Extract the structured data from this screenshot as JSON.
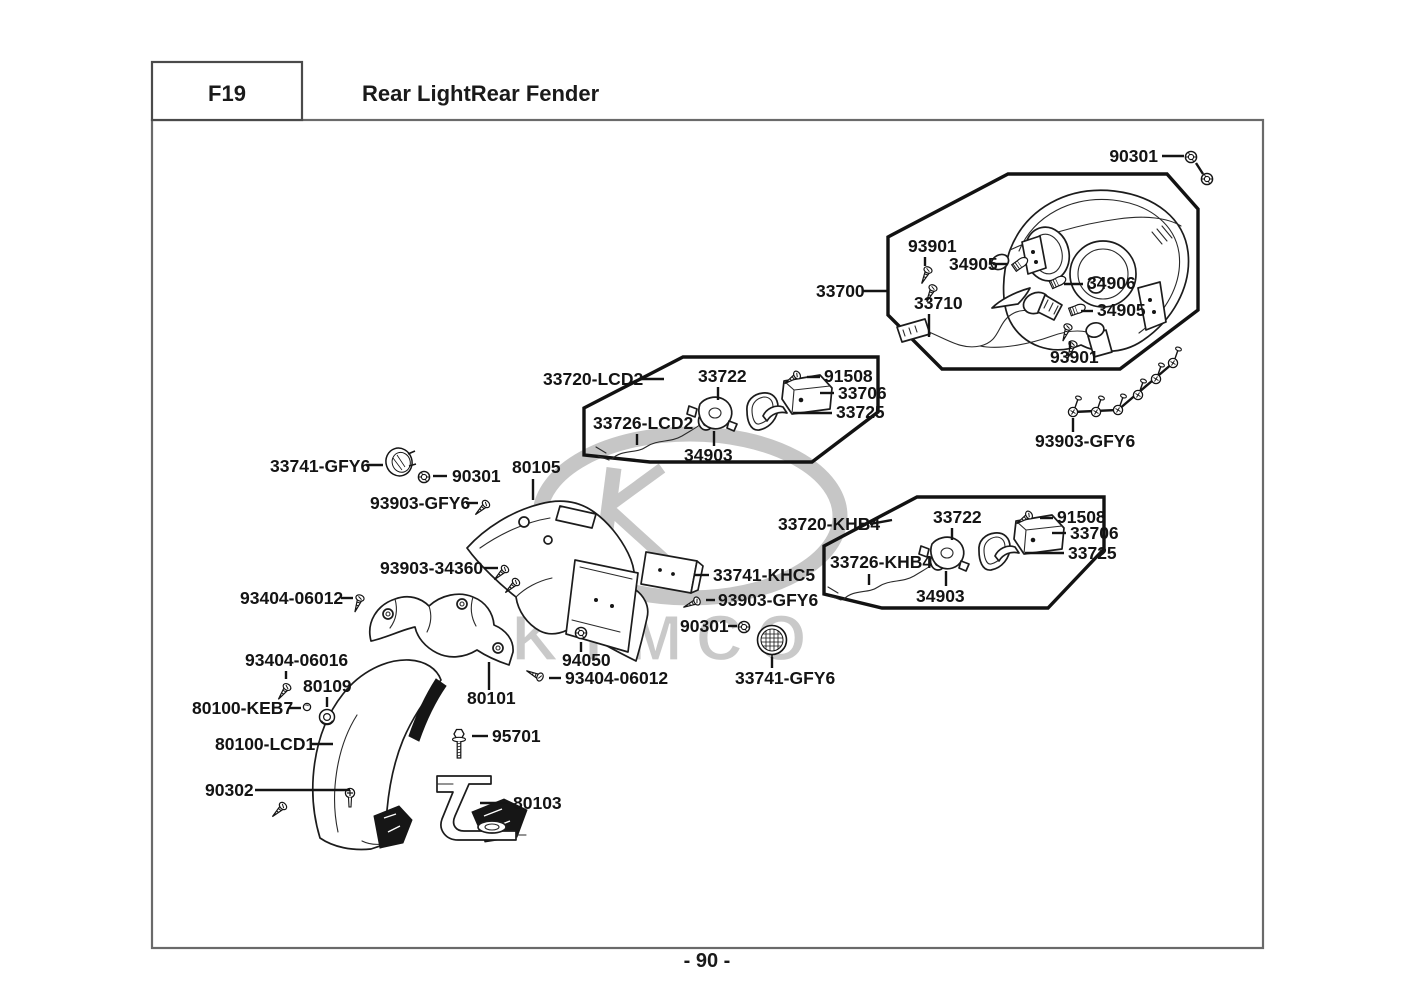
{
  "header": {
    "code": "F19",
    "title": "Rear LightRear Fender"
  },
  "footer": {
    "page_number": "- 90 -"
  },
  "watermark": {
    "brand": "KYMCO"
  },
  "diagram": {
    "assembly_groups": [
      "33700",
      "33720-LCD2",
      "33720-KHB4"
    ],
    "callouts": [
      {
        "part": "90301",
        "x": 1158,
        "y": 162,
        "anchor": "end",
        "leader": [
          [
            1162,
            156,
            1184,
            156
          ],
          [
            1196,
            163,
            1203,
            174
          ]
        ]
      },
      {
        "part": "93901",
        "x": 908,
        "y": 252,
        "anchor": "start",
        "leader": [
          [
            925,
            257,
            925,
            266
          ]
        ]
      },
      {
        "part": "34905",
        "x": 949,
        "y": 270,
        "anchor": "start",
        "leader": [
          [
            993,
            264,
            1007,
            264
          ]
        ]
      },
      {
        "part": "34906",
        "x": 1087,
        "y": 289,
        "anchor": "start",
        "leader": [
          [
            1083,
            284,
            1064,
            284
          ]
        ]
      },
      {
        "part": "34905",
        "x": 1097,
        "y": 316,
        "anchor": "start",
        "leader": [
          [
            1093,
            311,
            1081,
            311
          ]
        ]
      },
      {
        "part": "33710",
        "x": 914,
        "y": 309,
        "anchor": "start",
        "leader": [
          [
            929,
            314,
            929,
            337
          ]
        ]
      },
      {
        "part": "93901",
        "x": 1050,
        "y": 363,
        "anchor": "start",
        "leader": [
          [
            1070,
            349,
            1070,
            341
          ]
        ]
      },
      {
        "part": "33700",
        "x": 816,
        "y": 297,
        "anchor": "start",
        "leader": [
          [
            862,
            291,
            887,
            291
          ]
        ]
      },
      {
        "part": "33720-LCD2",
        "x": 543,
        "y": 385,
        "anchor": "start",
        "leader": [
          [
            641,
            379,
            664,
            379
          ]
        ]
      },
      {
        "part": "33722",
        "x": 698,
        "y": 382,
        "anchor": "start",
        "leader": [
          [
            718,
            387,
            718,
            400
          ]
        ]
      },
      {
        "part": "91508",
        "x": 824,
        "y": 382,
        "anchor": "start",
        "leader": [
          [
            820,
            377,
            807,
            377
          ]
        ]
      },
      {
        "part": "33706",
        "x": 838,
        "y": 399,
        "anchor": "start",
        "leader": [
          [
            834,
            393,
            820,
            393
          ]
        ]
      },
      {
        "part": "33725",
        "x": 836,
        "y": 418,
        "anchor": "start",
        "leader": [
          [
            832,
            413,
            793,
            413
          ]
        ]
      },
      {
        "part": "33726-LCD2",
        "x": 593,
        "y": 429,
        "anchor": "start",
        "leader": [
          [
            637,
            434,
            637,
            445
          ]
        ]
      },
      {
        "part": "34903",
        "x": 684,
        "y": 461,
        "anchor": "start",
        "leader": [
          [
            714,
            431,
            714,
            446
          ]
        ]
      },
      {
        "part": "93903-GFY6",
        "x": 1035,
        "y": 447,
        "anchor": "start",
        "leader": [
          [
            1073,
            432,
            1073,
            418
          ]
        ]
      },
      {
        "part": "33741-GFY6",
        "x": 270,
        "y": 472,
        "anchor": "start",
        "leader": [
          [
            366,
            465,
            383,
            465
          ]
        ]
      },
      {
        "part": "90301",
        "x": 452,
        "y": 482,
        "anchor": "start",
        "leader": [
          [
            447,
            476,
            433,
            476
          ]
        ]
      },
      {
        "part": "80105",
        "x": 512,
        "y": 473,
        "anchor": "start",
        "leader": [
          [
            533,
            479,
            533,
            500
          ]
        ]
      },
      {
        "part": "93903-GFY6",
        "x": 370,
        "y": 509,
        "anchor": "start",
        "leader": [
          [
            466,
            503,
            478,
            503
          ]
        ]
      },
      {
        "part": "93903-34360",
        "x": 380,
        "y": 574,
        "anchor": "start",
        "leader": [
          [
            484,
            568,
            498,
            568
          ]
        ]
      },
      {
        "part": "33741-KHC5",
        "x": 713,
        "y": 581,
        "anchor": "start",
        "leader": [
          [
            709,
            575,
            694,
            575
          ]
        ]
      },
      {
        "part": "93903-GFY6",
        "x": 718,
        "y": 606,
        "anchor": "start",
        "leader": [
          [
            715,
            600,
            706,
            600
          ]
        ]
      },
      {
        "part": "90301",
        "x": 680,
        "y": 632,
        "anchor": "start",
        "leader": [
          [
            728,
            626,
            737,
            626
          ]
        ]
      },
      {
        "part": "33741-GFY6",
        "x": 735,
        "y": 684,
        "anchor": "start",
        "leader": [
          [
            772,
            657,
            772,
            668
          ]
        ]
      },
      {
        "part": "94050",
        "x": 562,
        "y": 666,
        "anchor": "start",
        "leader": [
          [
            581,
            642,
            581,
            652
          ]
        ]
      },
      {
        "part": "93404-06012",
        "x": 565,
        "y": 684,
        "anchor": "start",
        "leader": [
          [
            561,
            678,
            549,
            678
          ]
        ]
      },
      {
        "part": "80101",
        "x": 467,
        "y": 704,
        "anchor": "start",
        "leader": [
          [
            489,
            690,
            489,
            662
          ]
        ]
      },
      {
        "part": "93404-06012",
        "x": 240,
        "y": 604,
        "anchor": "start",
        "leader": [
          [
            341,
            598,
            353,
            598
          ]
        ]
      },
      {
        "part": "93404-06016",
        "x": 245,
        "y": 666,
        "anchor": "start",
        "leader": [
          [
            286,
            671,
            286,
            679
          ]
        ]
      },
      {
        "part": "80109",
        "x": 303,
        "y": 692,
        "anchor": "start",
        "leader": [
          [
            327,
            697,
            327,
            707
          ]
        ]
      },
      {
        "part": "80100-KEB7",
        "x": 192,
        "y": 714,
        "anchor": "start",
        "leader": [
          [
            289,
            708,
            301,
            708
          ]
        ]
      },
      {
        "part": "80100-LCD1",
        "x": 215,
        "y": 750,
        "anchor": "start",
        "leader": [
          [
            312,
            744,
            333,
            744
          ]
        ]
      },
      {
        "part": "90302",
        "x": 205,
        "y": 796,
        "anchor": "start",
        "leader": [
          [
            255,
            790,
            350,
            790
          ]
        ]
      },
      {
        "part": "95701",
        "x": 492,
        "y": 742,
        "anchor": "start",
        "leader": [
          [
            488,
            736,
            472,
            736
          ]
        ]
      },
      {
        "part": "80103",
        "x": 513,
        "y": 809,
        "anchor": "start",
        "leader": [
          [
            508,
            803,
            480,
            803
          ]
        ]
      },
      {
        "part": "33720-KHB4",
        "x": 778,
        "y": 530,
        "anchor": "start",
        "leader": [
          [
            870,
            524,
            892,
            520
          ]
        ]
      },
      {
        "part": "33722",
        "x": 933,
        "y": 523,
        "anchor": "start",
        "leader": [
          [
            952,
            528,
            952,
            540
          ]
        ]
      },
      {
        "part": "91508",
        "x": 1057,
        "y": 523,
        "anchor": "start",
        "leader": [
          [
            1053,
            518,
            1040,
            518
          ]
        ]
      },
      {
        "part": "33706",
        "x": 1070,
        "y": 539,
        "anchor": "start",
        "leader": [
          [
            1066,
            533,
            1052,
            533
          ]
        ]
      },
      {
        "part": "33725",
        "x": 1068,
        "y": 559,
        "anchor": "start",
        "leader": [
          [
            1064,
            553,
            1025,
            553
          ]
        ]
      },
      {
        "part": "33726-KHB4",
        "x": 830,
        "y": 568,
        "anchor": "start",
        "leader": [
          [
            869,
            574,
            869,
            585
          ]
        ]
      },
      {
        "part": "34903",
        "x": 916,
        "y": 602,
        "anchor": "start",
        "leader": [
          [
            946,
            571,
            946,
            586
          ]
        ]
      }
    ]
  }
}
